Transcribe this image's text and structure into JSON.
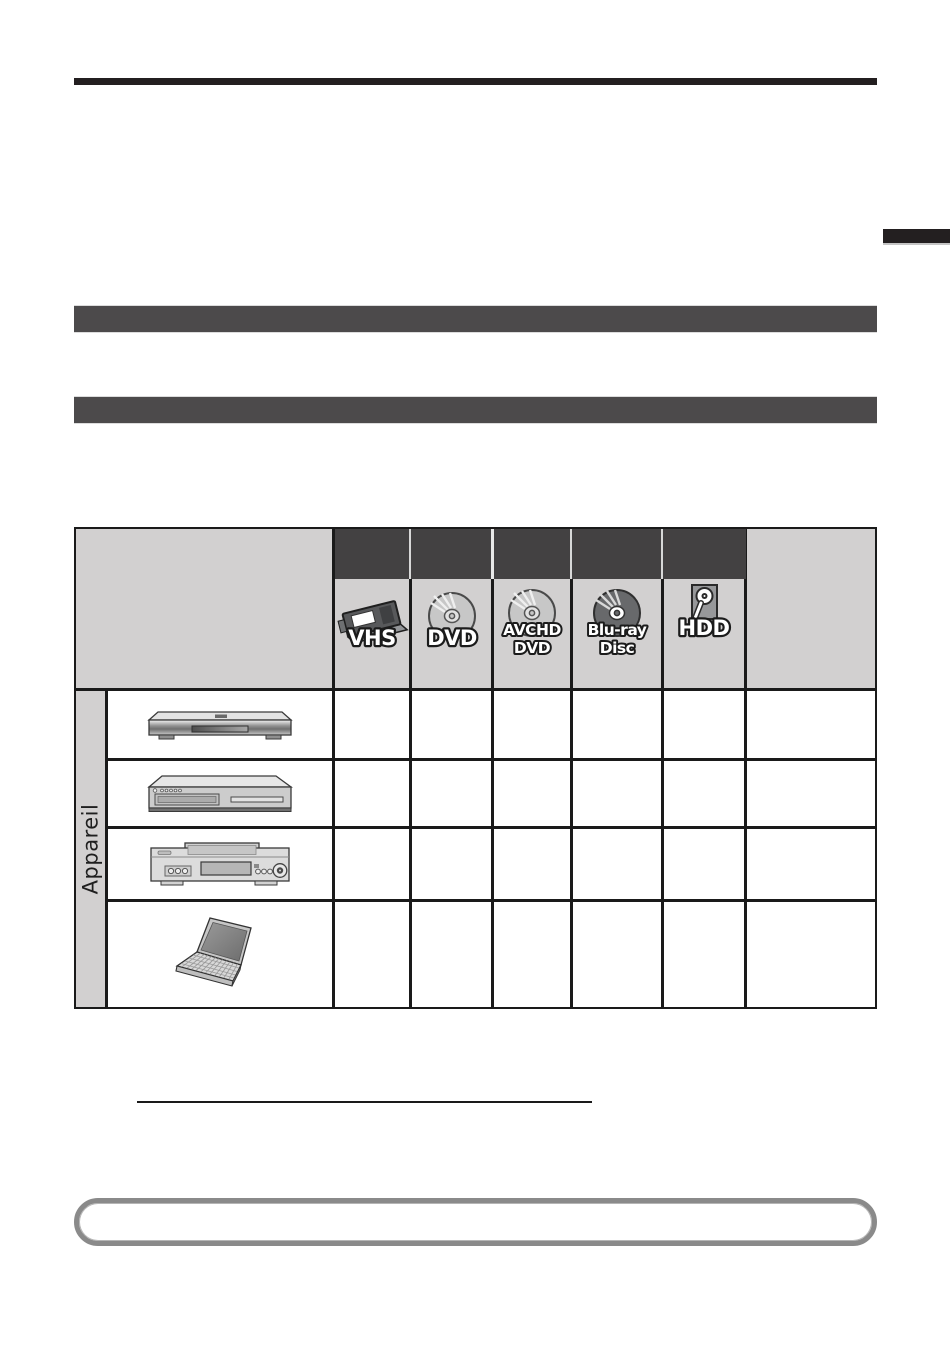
{
  "page": {
    "type": "manual-page",
    "background_color": "#ffffff"
  },
  "top_rule": {
    "color": "#231f20"
  },
  "side_tab": {
    "color": "#231f20"
  },
  "section_bars": {
    "color": "#4c4a4b"
  },
  "media_table": {
    "row_axis_label": "Appareil",
    "header": {
      "group_bar_color": "#434142",
      "header_bg_color": "#d2d0d0",
      "columns": [
        {
          "id": "vhs",
          "icon": "vhs-cassette-icon",
          "label": "VHS"
        },
        {
          "id": "dvd",
          "icon": "dvd-disc-icon",
          "label": "DVD"
        },
        {
          "id": "avchd-dvd",
          "icon": "avchd-disc-icon",
          "label_line1": "AVCHD",
          "label_line2": "DVD"
        },
        {
          "id": "blu-ray-disc",
          "icon": "blu-ray-disc-icon",
          "label_line1": "Blu-ray",
          "label_line2": "Disc"
        },
        {
          "id": "hdd",
          "icon": "hdd-drive-icon",
          "label": "HDD"
        }
      ]
    },
    "rows": [
      {
        "device": "blu-ray-disc-player"
      },
      {
        "device": "dvd-recorder"
      },
      {
        "device": "vhs-video-deck"
      },
      {
        "device": "laptop-computer"
      }
    ]
  },
  "footer": {
    "underline_color": "#1a1a1a",
    "note_box_border_color": "#8a8a8a"
  }
}
